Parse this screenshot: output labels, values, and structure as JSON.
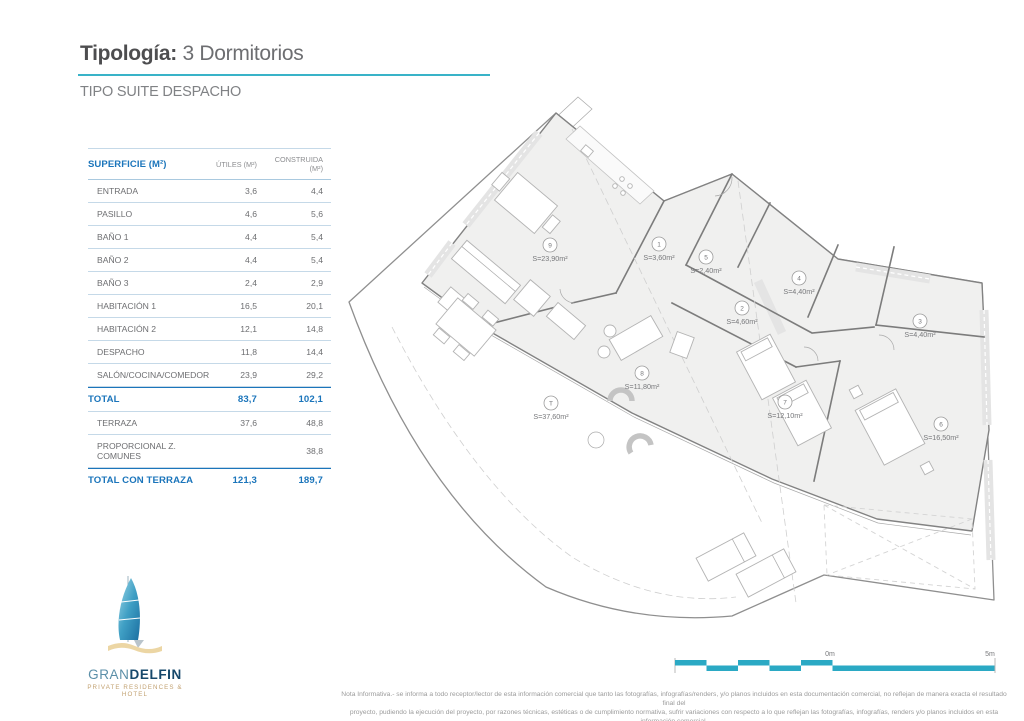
{
  "header": {
    "title_prefix": "Tipología:",
    "title_value": "3 Dormitorios",
    "subtitle": "TIPO SUITE DESPACHO"
  },
  "table": {
    "title": "SUPERFICIE (M²)",
    "col_utiles": "ÚTILES (M²)",
    "col_construida": "CONSTRUIDA (M²)",
    "rows": [
      {
        "label": "ENTRADA",
        "utiles": "3,6",
        "construida": "4,4",
        "style": "normal"
      },
      {
        "label": "PASILLO",
        "utiles": "4,6",
        "construida": "5,6",
        "style": "normal"
      },
      {
        "label": "BAÑO 1",
        "utiles": "4,4",
        "construida": "5,4",
        "style": "normal"
      },
      {
        "label": "BAÑO 2",
        "utiles": "4,4",
        "construida": "5,4",
        "style": "normal"
      },
      {
        "label": "BAÑO 3",
        "utiles": "2,4",
        "construida": "2,9",
        "style": "normal"
      },
      {
        "label": "HABITACIÓN 1",
        "utiles": "16,5",
        "construida": "20,1",
        "style": "normal"
      },
      {
        "label": "HABITACIÓN 2",
        "utiles": "12,1",
        "construida": "14,8",
        "style": "normal"
      },
      {
        "label": "DESPACHO",
        "utiles": "11,8",
        "construida": "14,4",
        "style": "normal"
      },
      {
        "label": "SALÓN/COCINA/COMEDOR",
        "utiles": "23,9",
        "construida": "29,2",
        "style": "normal"
      },
      {
        "label": "TOTAL",
        "utiles": "83,7",
        "construida": "102,1",
        "style": "total"
      },
      {
        "label": "TERRAZA",
        "utiles": "37,6",
        "construida": "48,8",
        "style": "normal"
      },
      {
        "label": "PROPORCIONAL Z. COMUNES",
        "utiles": "",
        "construida": "38,8",
        "style": "normal"
      },
      {
        "label": "TOTAL CON TERRAZA",
        "utiles": "121,3",
        "construida": "189,7",
        "style": "total"
      }
    ]
  },
  "plan": {
    "rooms": [
      {
        "num": "9",
        "area": "S=23,90m²",
        "x": 216,
        "y": 150
      },
      {
        "num": "1",
        "area": "S=3,60m²",
        "x": 325,
        "y": 149
      },
      {
        "num": "5",
        "area": "S=2,40m²",
        "x": 372,
        "y": 162
      },
      {
        "num": "2",
        "area": "S=4,60m²",
        "x": 408,
        "y": 213
      },
      {
        "num": "4",
        "area": "S=4,40m²",
        "x": 465,
        "y": 183
      },
      {
        "num": "3",
        "area": "S=4,40m²",
        "x": 586,
        "y": 226
      },
      {
        "num": "8",
        "area": "S=11,80m²",
        "x": 308,
        "y": 278
      },
      {
        "num": "T",
        "area": "S=37,60m²",
        "x": 217,
        "y": 308
      },
      {
        "num": "7",
        "area": "S=12,10m²",
        "x": 451,
        "y": 307
      },
      {
        "num": "6",
        "area": "S=16,50m²",
        "x": 607,
        "y": 329
      }
    ]
  },
  "scalebar": {
    "zero": "0m",
    "five": "5m"
  },
  "logo": {
    "gran": "GRAN",
    "delfin": "DELFIN",
    "tagline": "PRIVATE RESIDENCES & HOTEL"
  },
  "disclaimer": {
    "line1": "Nota Informativa.- se informa a todo receptor/lector de esta información comercial que tanto las fotografías, infografías/renders, y/o planos incluidos en esta documentación comercial, no reflejan de manera exacta el resultado final del",
    "line2": "proyecto, pudiendo la ejecución del proyecto, por razones técnicas, estéticas o de cumplimiento normativa, sufrir variaciones con respecto a lo que reflejan las fotografías, infografías, renders y/o planos incluidos en esta información comercial."
  },
  "colors": {
    "accent_cyan": "#39b3c8",
    "accent_blue": "#1b75bb",
    "text_gray": "#77787b",
    "logo_navy": "#16486b",
    "logo_teal": "#5b8fa8",
    "logo_sand": "#e8cf9e"
  }
}
